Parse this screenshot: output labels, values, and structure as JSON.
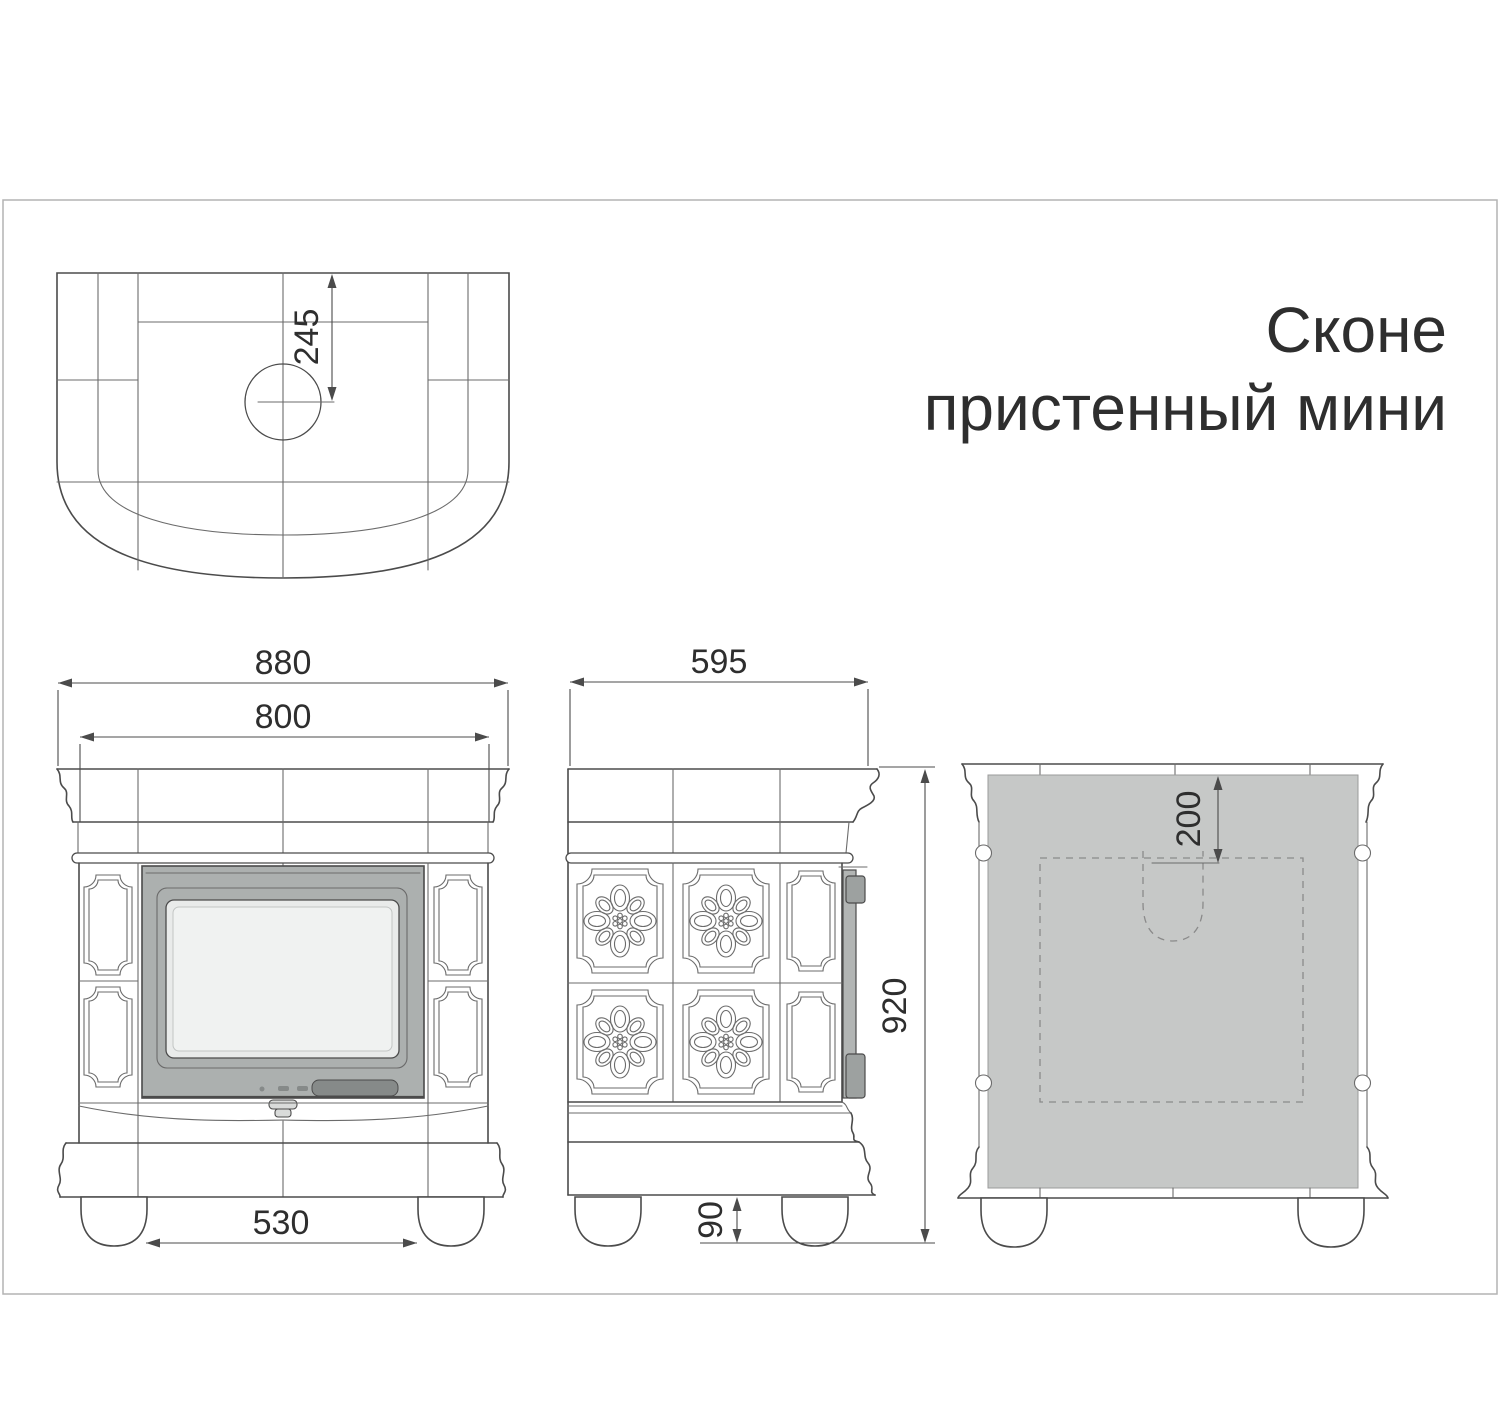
{
  "title": {
    "line1": "Сконе",
    "line2": "пристенный мини"
  },
  "dimensions": {
    "flue_center_from_back": "245",
    "overall_width": "880",
    "body_width": "800",
    "feet_inner_span": "530",
    "depth": "595",
    "overall_height": "920",
    "foot_height": "90",
    "flue_cutout_from_top": "200"
  },
  "colors": {
    "paper": "#ffffff",
    "sheet-border": "#b3b3b3",
    "line-main": "#4b4b4b",
    "line-thin": "#6b6b6b",
    "line-dash": "#8a8a8a",
    "text": "#2e2e2e",
    "panel-gray": "#c6c8c7",
    "door-frame": "#acb0af",
    "door-glass": "#e9ebea",
    "door-glass-inner": "#f0f2f1",
    "door-dark": "#868a89",
    "door-strip": "#b2b5b4",
    "hinge-gray": "#9da1a0",
    "knob": "#d9dbda"
  }
}
